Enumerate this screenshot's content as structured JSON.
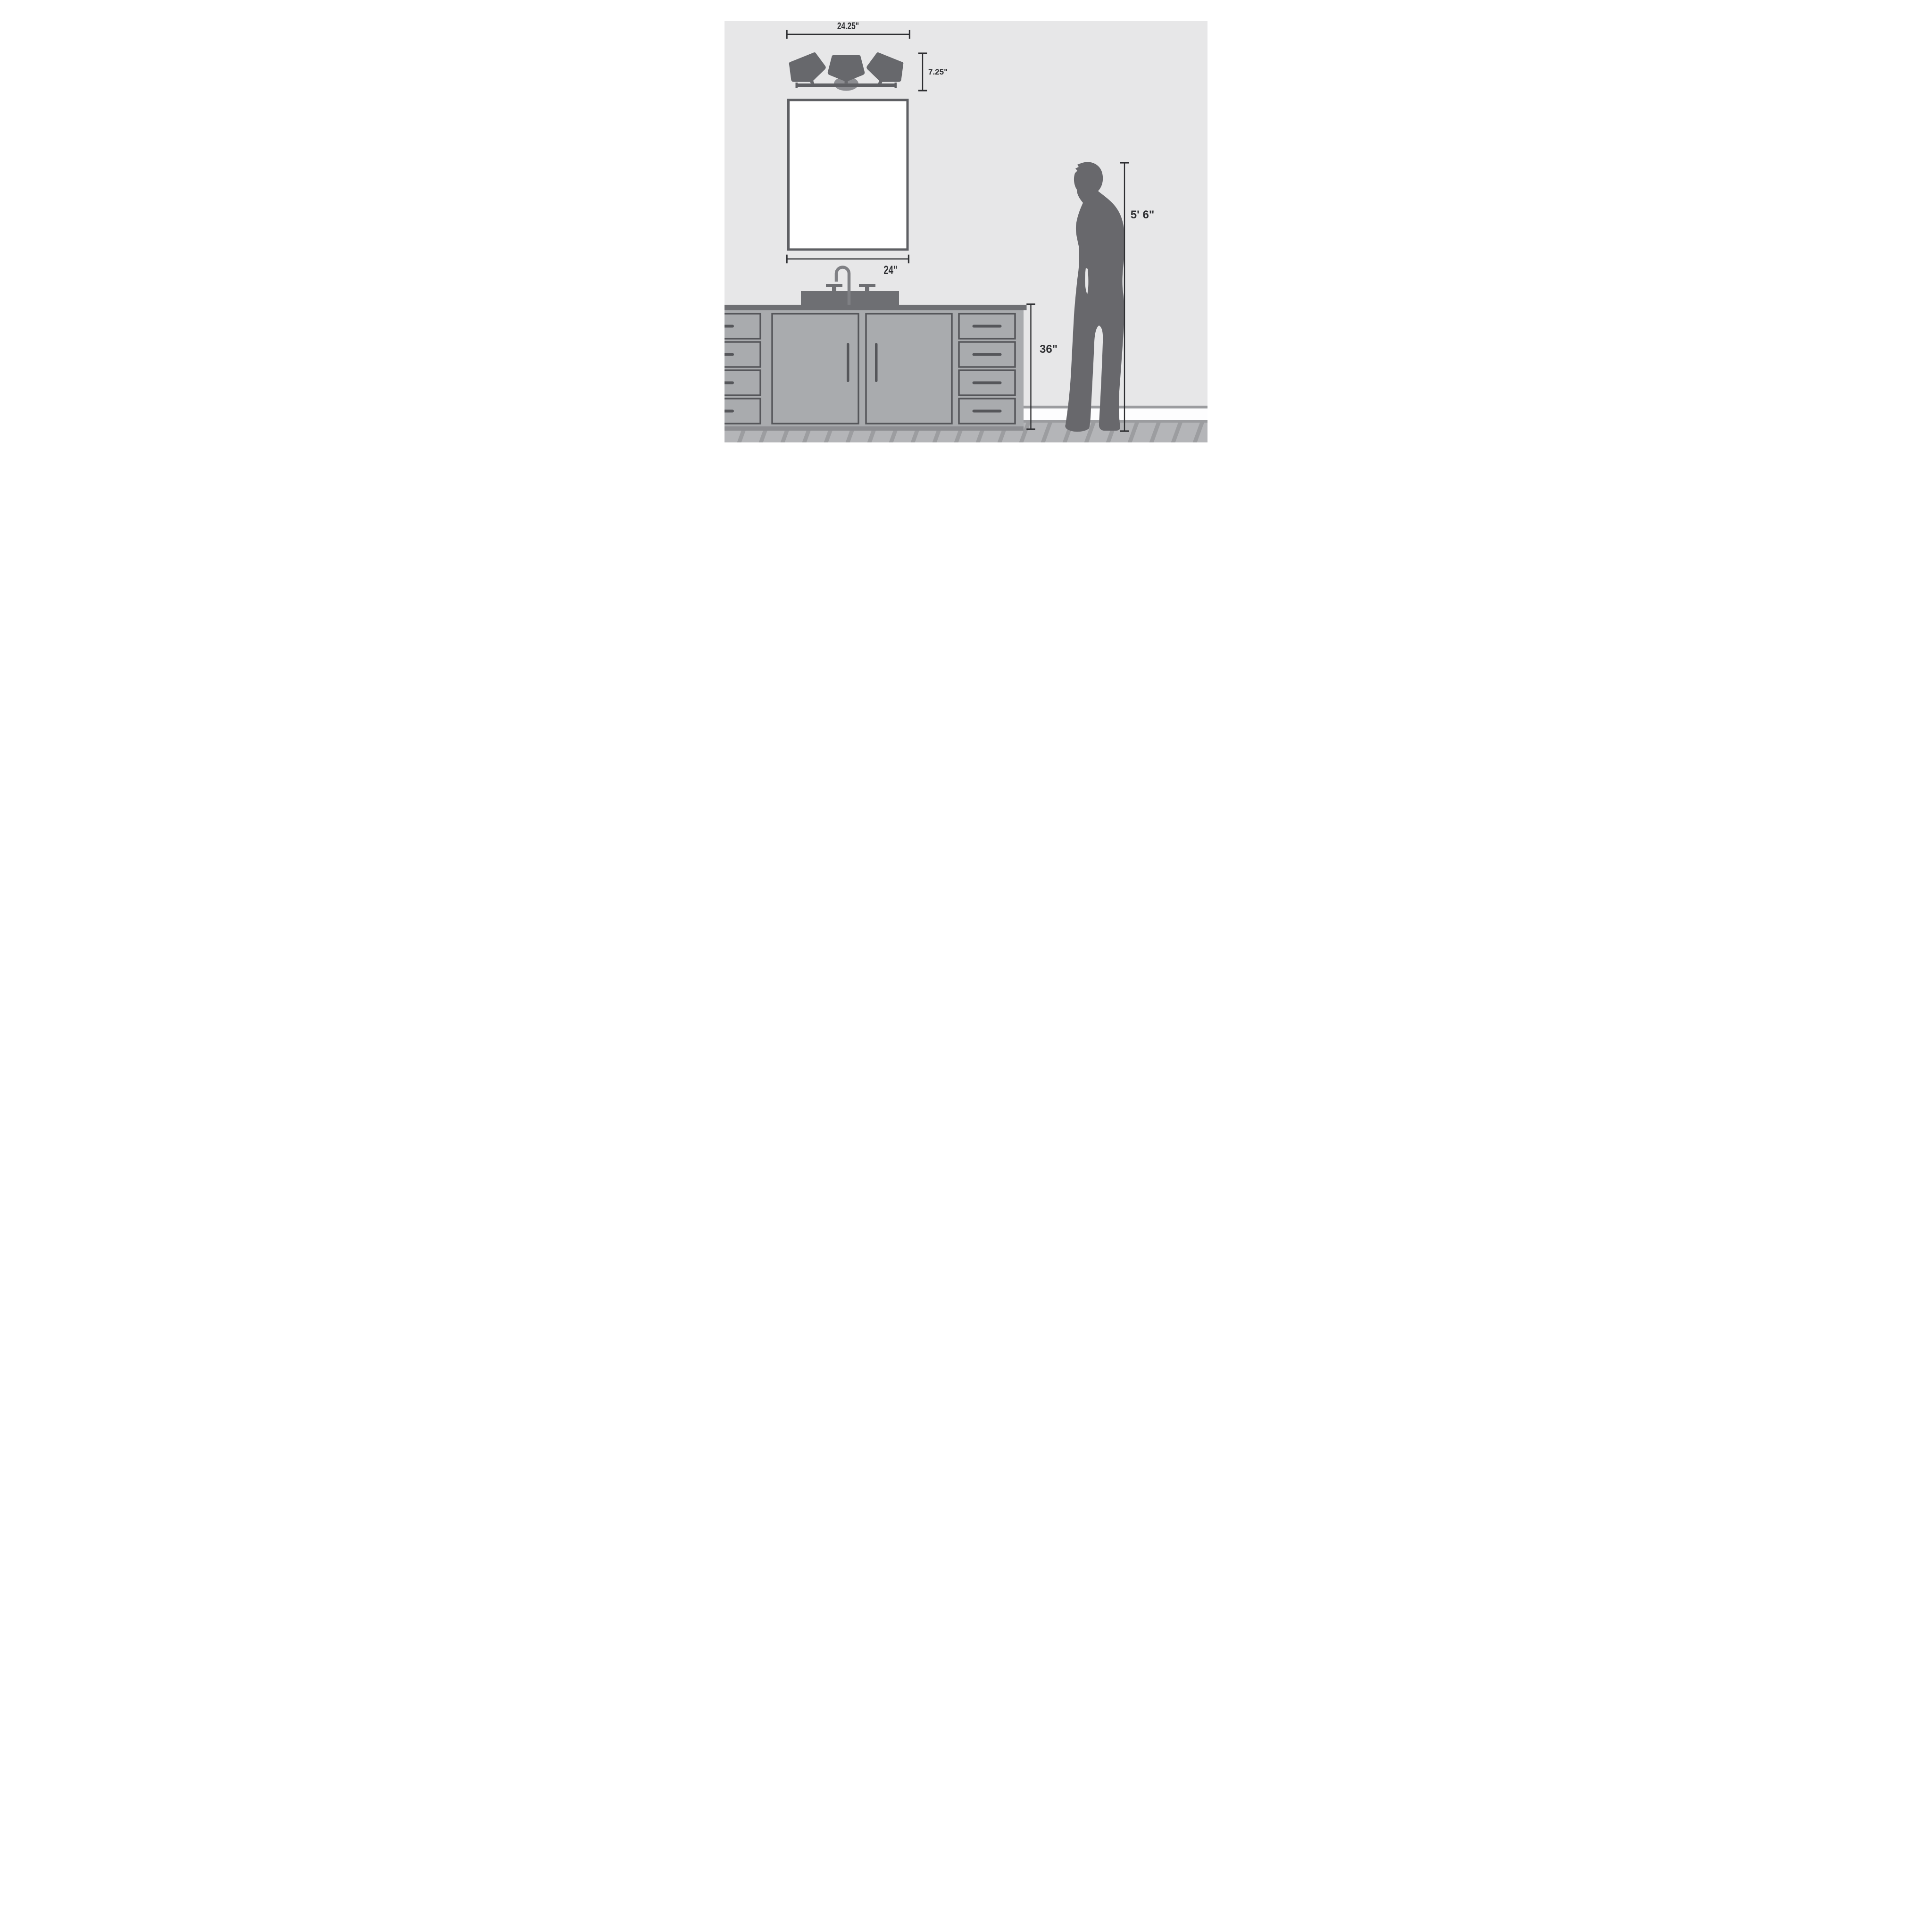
{
  "page": {
    "type": "bathroom-vanity-light-size-guide",
    "description": "Scale illustration of a 3-light bathroom vanity fixture above a mirror and sink cabinet, with a woman silhouette for scale"
  },
  "dimensions": {
    "fixture_width": "24.25\"",
    "fixture_height": "7.25\"",
    "mirror_width": "24\"",
    "vanity_height": "36\"",
    "person_height": "5' 6\""
  },
  "scene": {
    "objects": [
      "three-shade vanity light fixture",
      "round canopy backplate",
      "rectangular wall mirror",
      "gooseneck widespread faucet with two handles",
      "sink deck",
      "countertop",
      "vanity cabinet with two doors and eight drawers",
      "toe kick",
      "baseboard",
      "diagonal wood plank floor",
      "standing woman silhouette"
    ]
  },
  "colors": {
    "background": "#ffffff",
    "wall": "#e7e7e8",
    "dimension": "#2e2f32",
    "shade": "#67686c",
    "fixture_bar": "#5f6064",
    "canopy": "#8c8d91",
    "mirror_frame": "#5e5f63",
    "mirror_glass": "#ffffff",
    "faucet": "#7f8084",
    "counter": "#6e6f73",
    "cabinet": "#a9abae",
    "cabinet_outline": "#55565a",
    "toe_kick": "#8d8e92",
    "baseboard_trim": "#9b9c9f",
    "baseboard": "#fdfdfe",
    "floor": "#b4b5b8",
    "floor_stripe": "#9c9da0",
    "silhouette": "#68686c"
  }
}
